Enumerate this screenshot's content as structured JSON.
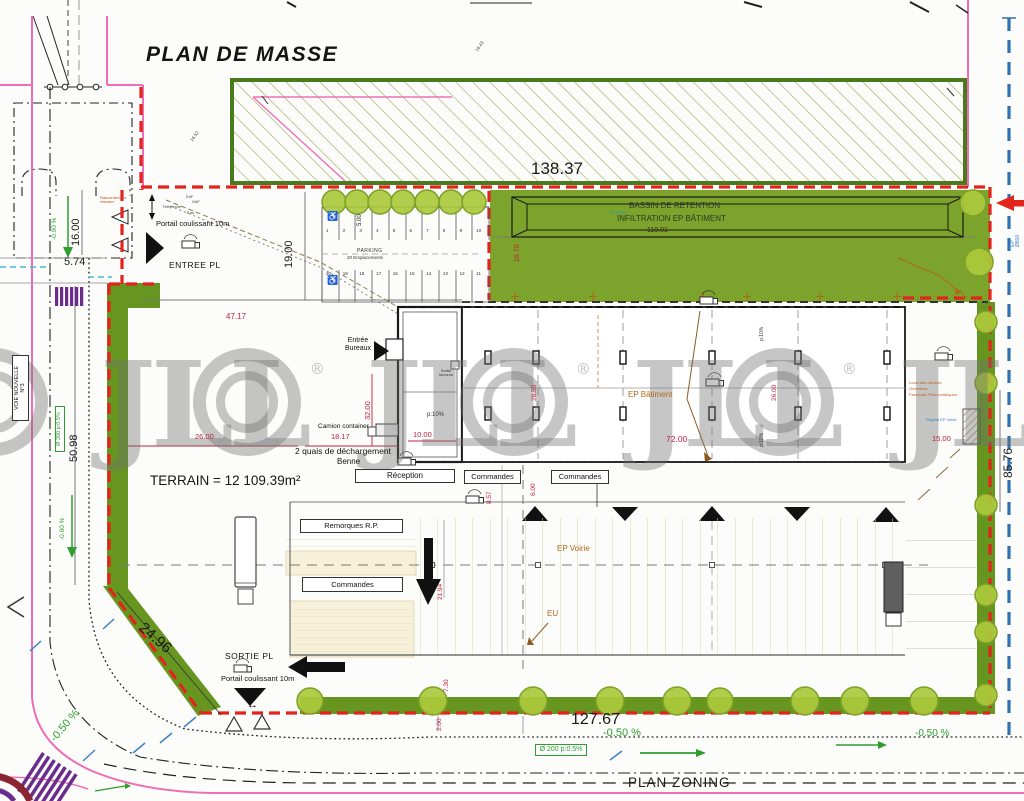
{
  "title": "PLAN DE MASSE",
  "watermark": {
    "text": "JLL",
    "reg": "®"
  },
  "colors": {
    "boundary-red": "#e2241c",
    "road-pink": "#ee6eb6",
    "grass": "#7ca32b",
    "hedge": "#679620",
    "tree-fill": "#abc93c",
    "tree-edge": "#7da029",
    "dim-red": "#c22040",
    "anno-green": "#2f9e2f",
    "anno-orange": "#b06818",
    "anno-blue": "#3b82c4",
    "blue-dash": "#2e72b2",
    "cream": "#f8f1da",
    "hatch-line": "#9aa85c",
    "hatch-border": "#4a7a1e",
    "ink": "#1a1a1a"
  },
  "parking": {
    "title": "PARKING",
    "subtitle": "20 Emplacements",
    "numbers_top": [
      1,
      2,
      3,
      4,
      5,
      6,
      7,
      8,
      9,
      10
    ],
    "numbers_bottom": [
      20,
      19,
      18,
      17,
      16,
      15,
      14,
      13,
      12,
      11
    ]
  },
  "labels": [
    {
      "n": "page-title",
      "t": "PLAN DE MASSE",
      "x": 146,
      "y": 44,
      "s": 21,
      "c": "#141414",
      "b": 1,
      "i": 1,
      "ls": 1.5
    },
    {
      "n": "dim-138-37",
      "t": "138.37",
      "x": 531,
      "y": 160,
      "s": 17,
      "c": "#1a1a1a"
    },
    {
      "n": "bassin-label-1",
      "t": "BASSIN DE RETENTION",
      "x": 629,
      "y": 202,
      "s": 8,
      "c": "#2a3a28"
    },
    {
      "n": "bassin-label-2",
      "t": "INFILTRATION EP BÂTIMENT",
      "x": 617,
      "y": 215,
      "s": 8,
      "c": "#2a3a28"
    },
    {
      "n": "dim-110-01",
      "t": "110.01",
      "x": 647,
      "y": 227,
      "s": 7,
      "c": "#402020"
    },
    {
      "n": "dim-16-70",
      "t": "16.70",
      "x": 514,
      "y": 262,
      "s": 7,
      "c": "#c22040",
      "r": -90
    },
    {
      "n": "fil-deau-note",
      "t": "Fil d'eau",
      "x": 610,
      "y": 211,
      "s": 4.5,
      "c": "#2a9a9a"
    },
    {
      "n": "dim-5-00",
      "t": "5.00",
      "x": 357,
      "y": 226,
      "s": 6,
      "c": "#222",
      "r": -90
    },
    {
      "n": "portail-coulissant-top",
      "t": "Portail coulissant 10m",
      "x": 156,
      "y": 220,
      "s": 7.5,
      "c": "#111"
    },
    {
      "n": "entree-pl-label",
      "t": "ENTREE PL",
      "x": 169,
      "y": 261,
      "s": 8.5,
      "c": "#111",
      "ls": 0.5
    },
    {
      "n": "utility-telephone",
      "t": "Téléphone",
      "x": 162,
      "y": 205,
      "s": 4,
      "c": "#444"
    },
    {
      "n": "utility-eau",
      "t": "Eau",
      "x": 187,
      "y": 211,
      "s": 4,
      "c": "#444"
    },
    {
      "n": "utility-edf",
      "t": "EdF",
      "x": 186,
      "y": 195,
      "s": 4,
      "c": "#444"
    },
    {
      "n": "utility-gdf",
      "t": "GdF",
      "x": 192,
      "y": 200,
      "s": 4,
      "c": "#444"
    },
    {
      "n": "raccordement-note",
      "t": "Raccordement\nréseaux",
      "x": 100,
      "y": 196,
      "s": 4,
      "c": "#c05020",
      "w": 32
    },
    {
      "n": "dim-19-00",
      "t": "19.00",
      "x": 284,
      "y": 268,
      "s": 11,
      "c": "#1a1a1a",
      "r": -90
    },
    {
      "n": "dim-47-17",
      "t": "47.17",
      "x": 226,
      "y": 313,
      "s": 8,
      "c": "#c22040"
    },
    {
      "n": "dim-16-00",
      "t": "16.00",
      "x": 71,
      "y": 246,
      "s": 11,
      "c": "#1a1a1a",
      "r": -90
    },
    {
      "n": "dim-5-74",
      "t": "5.74",
      "x": 64,
      "y": 257,
      "s": 11,
      "c": "#1a1a1a"
    },
    {
      "n": "dim-50-98",
      "t": "50.98",
      "x": 69,
      "y": 462,
      "s": 11,
      "c": "#1a1a1a",
      "r": -90
    },
    {
      "n": "voie-nouvelle-label",
      "t": "VOIE NOUVELLE\nN°3",
      "x": 12,
      "y": 421,
      "s": 5.5,
      "c": "#111",
      "r": -90,
      "box": 1,
      "w": 66,
      "h": 17
    },
    {
      "n": "pipe-note-left",
      "t": "Ø 200  p:0.5%",
      "x": 55,
      "y": 452,
      "s": 5.5,
      "c": "#2f9e2f",
      "r": -90,
      "box": 1,
      "w": 46,
      "h": 10,
      "bc": "#2f9e2f"
    },
    {
      "n": "slope-note-060",
      "t": "-0.60 %",
      "x": 59,
      "y": 540,
      "s": 6.5,
      "c": "#2f9e2f",
      "r": -90
    },
    {
      "n": "slope-note-090",
      "t": "-0.90 %",
      "x": 51,
      "y": 240,
      "s": 6.5,
      "c": "#2f9e2f",
      "r": -90
    },
    {
      "n": "terrain-area",
      "t": "TERRAIN  = 12 109.39m²",
      "x": 150,
      "y": 474,
      "s": 13.5,
      "c": "#161616"
    },
    {
      "n": "dim-26-00",
      "t": "26.00",
      "x": 195,
      "y": 433,
      "s": 7.5,
      "c": "#c22040"
    },
    {
      "n": "dim-18-17",
      "t": "18.17",
      "x": 331,
      "y": 433,
      "s": 7.5,
      "c": "#c22040"
    },
    {
      "n": "quais-label",
      "t": "2 quais de déchargement",
      "x": 295,
      "y": 447,
      "s": 8.5,
      "c": "#111"
    },
    {
      "n": "benne-label",
      "t": "Benne",
      "x": 337,
      "y": 458,
      "s": 8,
      "c": "#111"
    },
    {
      "n": "camion-container-label",
      "t": "Camion container",
      "x": 318,
      "y": 423,
      "s": 6.5,
      "c": "#111"
    },
    {
      "n": "entree-bureaux-label",
      "t": "Entrée\nBureaux",
      "x": 342,
      "y": 337,
      "s": 7,
      "c": "#111",
      "w": 32,
      "a": "center"
    },
    {
      "n": "sortie-secours-note",
      "t": "Sortie\nsecours",
      "x": 436,
      "y": 369,
      "s": 4,
      "c": "#333",
      "w": 20,
      "a": "center"
    },
    {
      "n": "slope-p10-office",
      "t": "p:10%",
      "x": 427,
      "y": 412,
      "s": 6,
      "c": "#333"
    },
    {
      "n": "dim-10-00",
      "t": "10.00",
      "x": 413,
      "y": 431,
      "s": 7.5,
      "c": "#c22040"
    },
    {
      "n": "dim-32-00",
      "t": "32.00",
      "x": 364,
      "y": 420,
      "s": 7.5,
      "c": "#c22040",
      "r": -90
    },
    {
      "n": "dim-8-57",
      "t": "8.57",
      "x": 486,
      "y": 504,
      "s": 6.5,
      "c": "#c22040",
      "r": -90
    },
    {
      "n": "dim-6-00",
      "t": "6.00",
      "x": 530,
      "y": 496,
      "s": 6.5,
      "c": "#c22040",
      "r": -90
    },
    {
      "n": "dim-28-50",
      "t": "28.50",
      "x": 531,
      "y": 401,
      "s": 6.5,
      "c": "#c22040",
      "r": -90
    },
    {
      "n": "dim-26-00-hall",
      "t": "26.00",
      "x": 771,
      "y": 401,
      "s": 6.5,
      "c": "#c22040",
      "r": -90
    },
    {
      "n": "dim-72-00",
      "t": "72.00",
      "x": 666,
      "y": 435,
      "s": 8.5,
      "c": "#c22040"
    },
    {
      "n": "ep-batiment-label",
      "t": "EP Bâtiment",
      "x": 628,
      "y": 391,
      "s": 8,
      "c": "#b06818"
    },
    {
      "n": "slope-p10-roof-1",
      "t": "p:10%",
      "x": 760,
      "y": 341,
      "s": 5,
      "c": "#333",
      "r": -90
    },
    {
      "n": "slope-p10-roof-2",
      "t": "p:10%",
      "x": 760,
      "y": 447,
      "s": 5,
      "c": "#333",
      "r": -90
    },
    {
      "n": "reception-label",
      "t": "Réception",
      "x": 355,
      "y": 469,
      "s": 8,
      "c": "#111",
      "box": 1,
      "w": 100,
      "h": 14
    },
    {
      "n": "commandes-label-1",
      "t": "Commandes",
      "x": 464,
      "y": 470,
      "s": 7.5,
      "c": "#111",
      "box": 1,
      "w": 57,
      "h": 14
    },
    {
      "n": "commandes-label-2",
      "t": "Commandes",
      "x": 551,
      "y": 470,
      "s": 7.5,
      "c": "#111",
      "box": 1,
      "w": 58,
      "h": 14
    },
    {
      "n": "remorques-label",
      "t": "Remorques R.P.",
      "x": 300,
      "y": 519,
      "s": 7.5,
      "c": "#111",
      "box": 1,
      "w": 103,
      "h": 14
    },
    {
      "n": "commandes-label-3",
      "t": "Commandes",
      "x": 302,
      "y": 577,
      "s": 7.5,
      "c": "#111",
      "box": 1,
      "w": 101,
      "h": 15
    },
    {
      "n": "ep-voirie-label",
      "t": "EP Voirie",
      "x": 557,
      "y": 545,
      "s": 8,
      "c": "#b06818"
    },
    {
      "n": "eu-label",
      "t": "EU",
      "x": 547,
      "y": 610,
      "s": 8,
      "c": "#b06818"
    },
    {
      "n": "dim-21-94",
      "t": "21.94",
      "x": 437,
      "y": 600,
      "s": 6.5,
      "c": "#c22040",
      "r": -90
    },
    {
      "n": "sortie-pl-label",
      "t": "SORTIE PL",
      "x": 225,
      "y": 652,
      "s": 8.5,
      "c": "#111",
      "ls": 0.5
    },
    {
      "n": "portail-coulissant-bottom",
      "t": "Portail coulissant 10m",
      "x": 221,
      "y": 675,
      "s": 7.5,
      "c": "#111"
    },
    {
      "n": "gate-double-arrow",
      "t": "↔",
      "x": 247,
      "y": 700,
      "s": 11,
      "c": "#111"
    },
    {
      "n": "dim-24-96",
      "t": "24.96",
      "x": 146,
      "y": 620,
      "s": 15,
      "c": "#1a1a1a",
      "r": 41
    },
    {
      "n": "dim-127-67",
      "t": "127.67",
      "x": 571,
      "y": 711,
      "s": 16,
      "c": "#1a1a1a"
    },
    {
      "n": "dim-7-30",
      "t": "7.30",
      "x": 443,
      "y": 692,
      "s": 6.5,
      "c": "#c22040",
      "r": -90
    },
    {
      "n": "dim-2-00",
      "t": "2.00",
      "x": 436,
      "y": 731,
      "s": 6.5,
      "c": "#c22040",
      "r": -90
    },
    {
      "n": "slope-note-050-center",
      "t": "-0.50 %",
      "x": 603,
      "y": 728,
      "s": 11,
      "c": "#2f9e2f"
    },
    {
      "n": "slope-note-050-right",
      "t": "-0.50 %",
      "x": 915,
      "y": 729,
      "s": 10,
      "c": "#2f9e2f"
    },
    {
      "n": "slope-note-050-left",
      "t": "-0.50 %",
      "x": 49,
      "y": 737,
      "s": 11,
      "c": "#2f9e2f",
      "r": -50
    },
    {
      "n": "pipe-note-bottom",
      "t": "Ø 200  p:0.5%",
      "x": 535,
      "y": 744,
      "s": 7,
      "c": "#2f9e2f",
      "box": 1,
      "w": 52,
      "h": 12,
      "bc": "#2f9e2f"
    },
    {
      "n": "plan-zoning-title",
      "t": "PLAN ZONING",
      "x": 628,
      "y": 776,
      "s": 13.5,
      "c": "#1a1a1a",
      "ls": 1
    },
    {
      "n": "dim-85-76",
      "t": "85.76",
      "x": 1002,
      "y": 478,
      "s": 12,
      "c": "#1a1a1a",
      "r": -90
    },
    {
      "n": "dim-15-00",
      "t": "15.00",
      "x": 932,
      "y": 435,
      "s": 7.5,
      "c": "#c22040"
    },
    {
      "n": "local-dechets-note",
      "t": "Local abri déchets",
      "x": 909,
      "y": 381,
      "s": 4,
      "c": "#c06020"
    },
    {
      "n": "ombrieres-note",
      "t": "Ombrières",
      "x": 909,
      "y": 387,
      "s": 4,
      "c": "#c06020"
    },
    {
      "n": "photovoltaique-note",
      "t": "Panneaux Photovoltaïques",
      "x": 909,
      "y": 393,
      "s": 4,
      "c": "#c06020"
    },
    {
      "n": "regard-ep-note",
      "t": "Regard EP Voirie",
      "x": 926,
      "y": 418,
      "s": 4,
      "c": "#3b82c4"
    },
    {
      "n": "ep800-note",
      "t": "EP Ø800",
      "x": 1011,
      "y": 247,
      "s": 5,
      "c": "#3b82c4",
      "r": -90
    },
    {
      "n": "spot-level-1",
      "t": "16.43",
      "x": 475,
      "y": 50,
      "s": 4.5,
      "c": "#444",
      "r": -55
    },
    {
      "n": "spot-level-2",
      "t": "16.52",
      "x": 190,
      "y": 140,
      "s": 4.5,
      "c": "#444",
      "r": -55
    },
    {
      "n": "handicap-icon-1",
      "t": "♿",
      "x": 327,
      "y": 212,
      "s": 9,
      "c": "#15427e"
    },
    {
      "n": "handicap-icon-2",
      "t": "♿",
      "x": 327,
      "y": 276,
      "s": 9,
      "c": "#15427e"
    },
    {
      "n": "parking-title",
      "t": "PARKING",
      "x": 357,
      "y": 249,
      "s": 5,
      "c": "#333",
      "ls": 0.5
    },
    {
      "n": "parking-subtitle",
      "t": "20 Emplacements",
      "x": 347,
      "y": 256,
      "s": 4.5,
      "c": "#333"
    }
  ]
}
